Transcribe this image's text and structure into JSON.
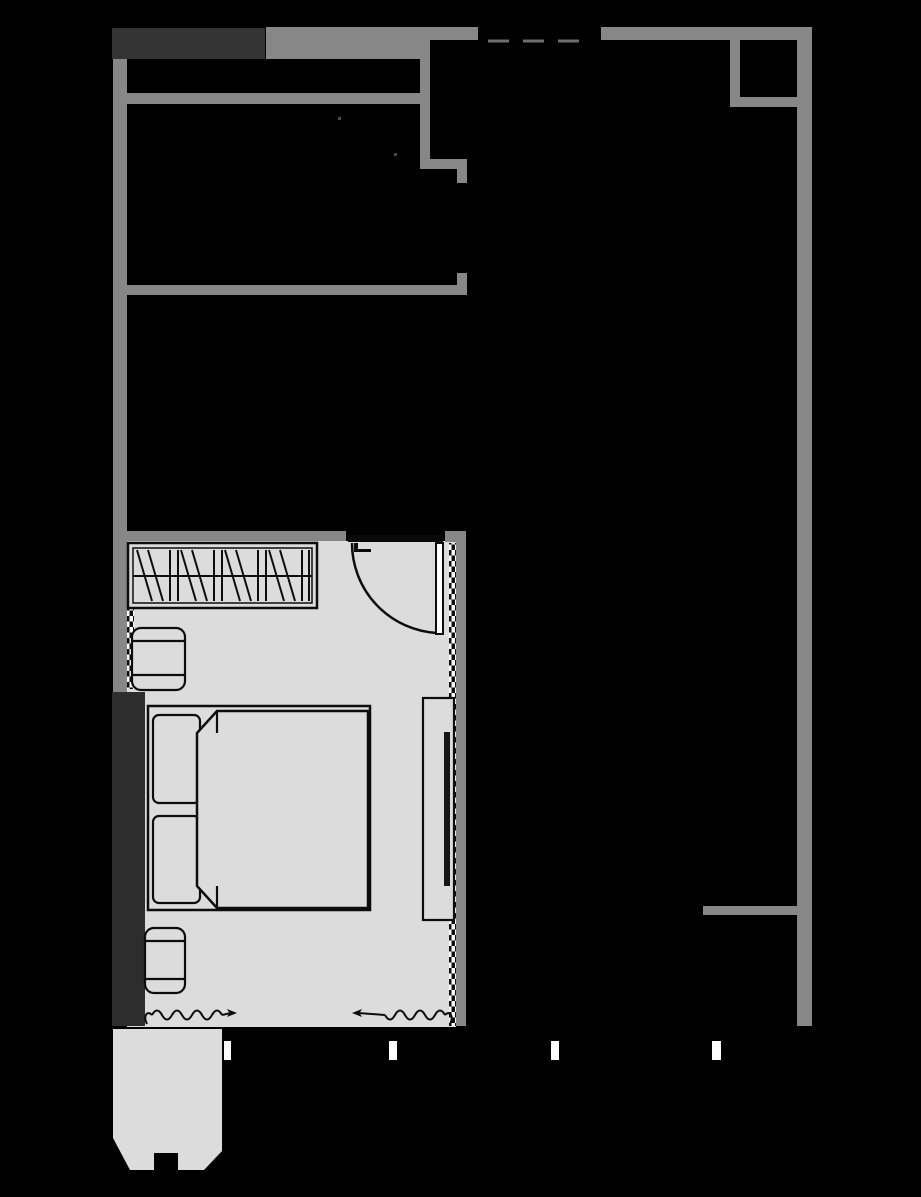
{
  "meta": {
    "type": "floor-plan",
    "description": "Architectural floor plan on black background: apartment outline in gray walls, one furnished bedroom with wardrobe, double bed, nightstands, TV console, swing door, window curtains, and a chamfered balcony at bottom left",
    "canvas": {
      "width": 921,
      "height": 1197
    }
  },
  "palette": {
    "background": "#000000",
    "wall_gray": "#878787",
    "wall_dark_block": "#333333",
    "pier_dark": "#2d2d2d",
    "floor_light": "#dcdcdc",
    "outline": "#0d0d0d",
    "door_lintel": "#0a0a0a",
    "tick_white": "#ffffff",
    "dashed_line": "#6e6e6e",
    "tv_dark": "#151515",
    "door_leaf_fill": "#ffffff"
  },
  "elements": {
    "exterior": {
      "top_band": [
        "dark-party-wall-block",
        "gray-wall-block"
      ],
      "right_wall_span_y": [
        27,
        1026
      ],
      "dashed_opening": {
        "y": 41,
        "from_x": 488,
        "to_x": 593
      },
      "top_right_niche": "small L-shaped shaft walls"
    },
    "interior_partitions": [
      "upper-horizontal-wall",
      "middle-horizontal-wall",
      "wall-jog-with-door-gap",
      "bedroom-top-wall-with-door-opening",
      "bedroom-right-wall",
      "right-stub-wall"
    ],
    "bedroom": {
      "floor": "light gray",
      "furniture": [
        "wardrobe-with-hanger-symbols",
        "double-bed",
        "pillow-top",
        "pillow-bottom",
        "duvet-with-folded-corners",
        "nightstand-upper",
        "nightstand-lower",
        "tv-console",
        "tv-panel"
      ],
      "symbols": [
        "door-swing-arc",
        "open-door-leaf",
        "door-latch-mark",
        "glazing-zipper-right-wall",
        "glazing-zipper-left-wall",
        "curtain-wave-left",
        "curtain-wave-right"
      ]
    },
    "balcony": {
      "shape": "polygon with 45-degree chamfered bottom corners and central notch",
      "fill": "light gray"
    },
    "grid_ticks": {
      "count": 4,
      "y": 1041,
      "height": 19,
      "positions_x": [
        224,
        389,
        551,
        712
      ]
    }
  }
}
